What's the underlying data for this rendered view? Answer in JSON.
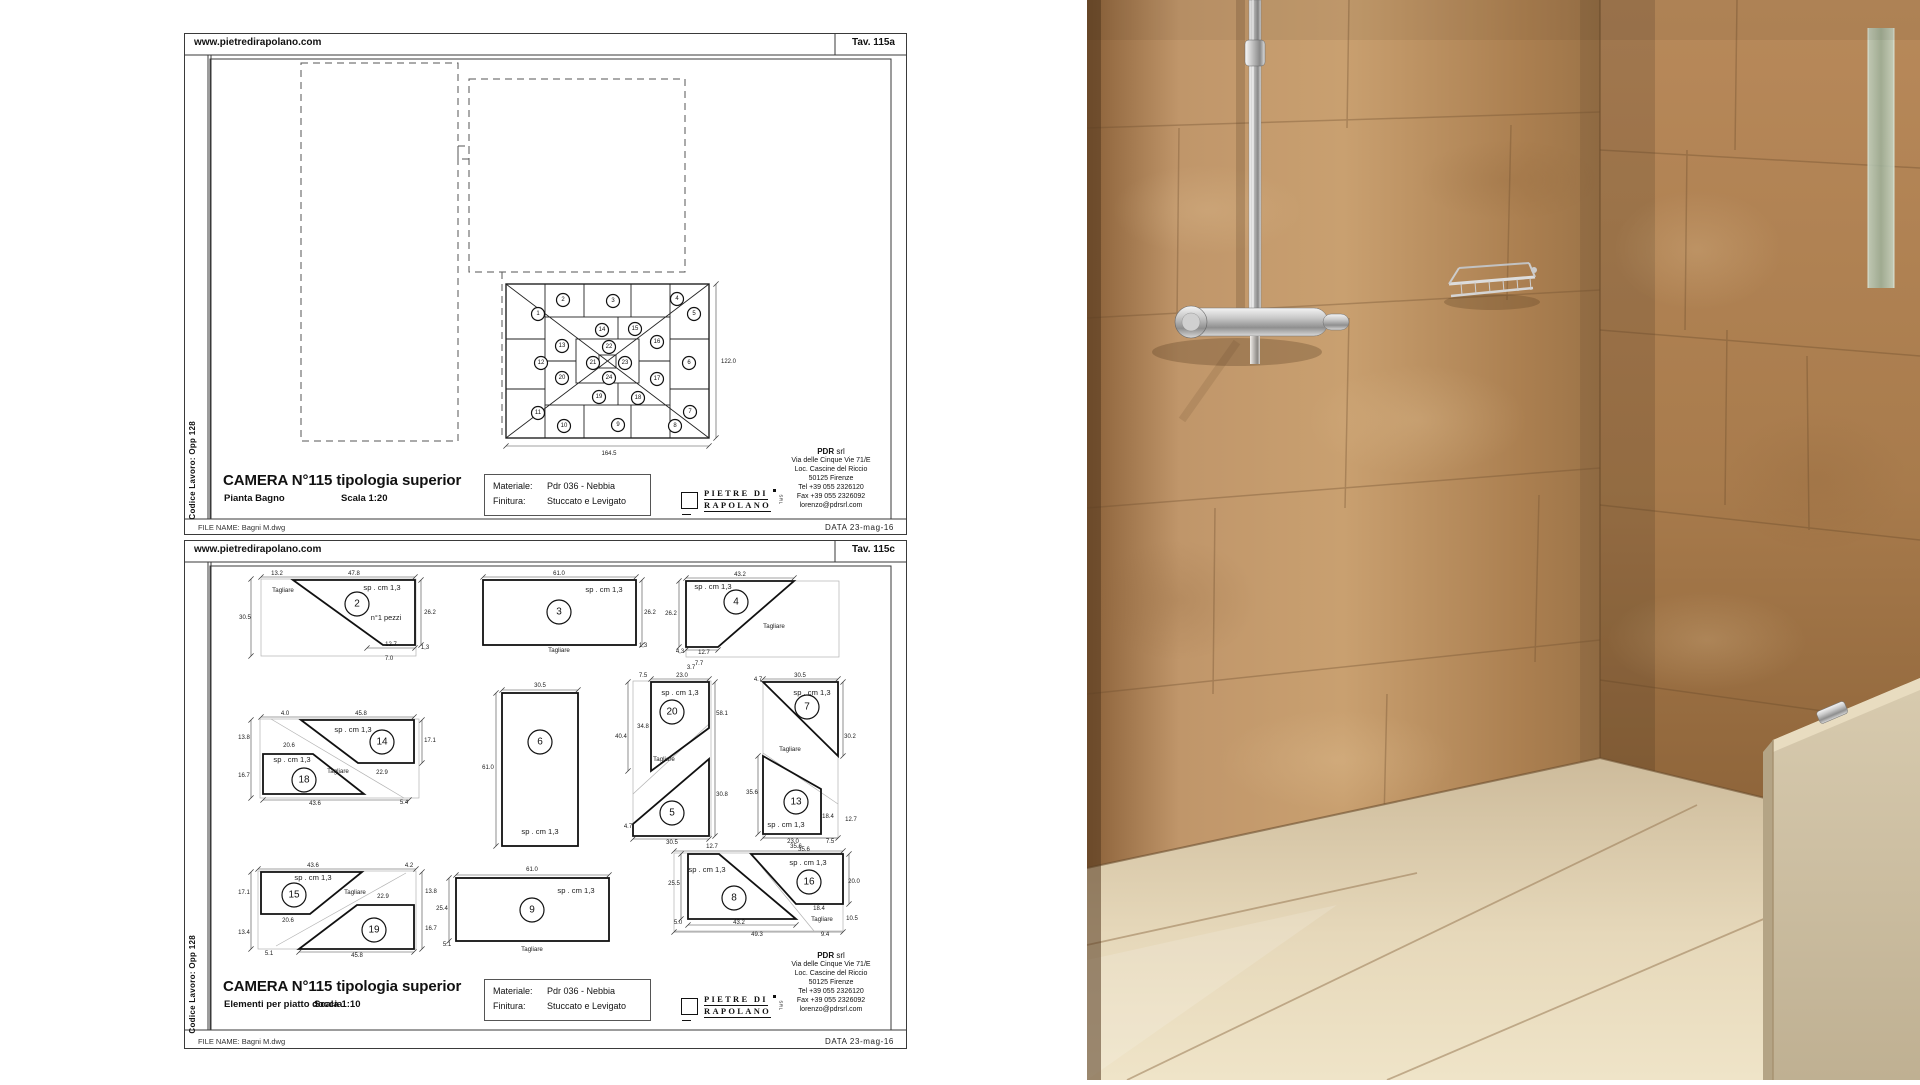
{
  "colors": {
    "paper": "#ffffff",
    "line": "#1a1a1a",
    "wall_left": "#c09366",
    "wall_right": "#a87a4b",
    "floor": "#e3d5b6",
    "half_wall": "#cfc1a5",
    "chrome": "#d9d9d9",
    "glass": "#a9bcae"
  },
  "sheet1": {
    "header": {
      "url": "www.pietredirapolano.com",
      "tav": "Tav. 115a"
    },
    "side_label": "Codice Lavoro: Opp 128",
    "title": "CAMERA N°115 tipologia superior",
    "subtitle": "Pianta Bagno",
    "scale": "Scala 1:20",
    "material_box": {
      "rows": [
        [
          "Materiale:",
          "Pdr 036 - Nebbia"
        ],
        [
          "Finitura:",
          "Stuccato e Levigato"
        ]
      ]
    },
    "logo": {
      "top": "PIETRE DI",
      "bottom": "RAPOLANO",
      "mark": "SRL"
    },
    "address": {
      "company": "PDR",
      "company_suffix": " srl",
      "lines": [
        "Via delle Cinque Vie 71/E",
        "Loc. Cascine del Riccio",
        "50125 Firenze",
        "Tel +39  055 2326120",
        "Fax +39 055 2326092",
        "lorenzo@pdrsrl.com"
      ]
    },
    "footer": {
      "file": "FILE NAME: Bagni M.dwg",
      "date": "DATA 23-mag-16"
    },
    "plan": {
      "dims": [
        [
          "122.0",
          536,
          329,
          "start"
        ],
        [
          "164.5",
          424,
          421,
          "middle"
        ]
      ],
      "dimlines": [
        [
          531,
          250,
          531,
          404
        ],
        [
          321,
          412,
          524,
          412
        ]
      ],
      "tile_numbers": [
        [
          1,
          353,
          280
        ],
        [
          2,
          378,
          266
        ],
        [
          3,
          428,
          267
        ],
        [
          4,
          492,
          265
        ],
        [
          5,
          509,
          280
        ],
        [
          6,
          504,
          329
        ],
        [
          7,
          505,
          378
        ],
        [
          8,
          490,
          392
        ],
        [
          9,
          433,
          391
        ],
        [
          10,
          379,
          392
        ],
        [
          11,
          353,
          379
        ],
        [
          12,
          356,
          329
        ],
        [
          13,
          377,
          312
        ],
        [
          14,
          417,
          296
        ],
        [
          15,
          450,
          295
        ],
        [
          16,
          472,
          308
        ],
        [
          17,
          472,
          345
        ],
        [
          18,
          453,
          364
        ],
        [
          19,
          414,
          363
        ],
        [
          20,
          377,
          344
        ],
        [
          21,
          408,
          329
        ],
        [
          22,
          424,
          313
        ],
        [
          23,
          440,
          329
        ],
        [
          24,
          424,
          344
        ]
      ]
    }
  },
  "sheet2": {
    "header": {
      "url": "www.pietredirapolano.com",
      "tav": "Tav. 115c"
    },
    "side_label": "Codice Lavoro: Opp 128",
    "title": "CAMERA N°115 tipologia superior",
    "subtitle": "Elementi per piatto doccia",
    "scale": "Scala 1:10",
    "material_box": {
      "rows": [
        [
          "Materiale:",
          "Pdr 036 - Nebbia"
        ],
        [
          "Finitura:",
          "Stuccato e Levigato"
        ]
      ]
    },
    "logo": {
      "top": "PIETRE DI",
      "bottom": "RAPOLANO",
      "mark": "SRL"
    },
    "address": {
      "company": "PDR",
      "company_suffix": " srl",
      "lines": [
        "Via delle Cinque Vie 71/E",
        "Loc. Cascine del Riccio",
        "50125 Firenze",
        "Tel +39  055 2326120",
        "Fax +39 055 2326092",
        "lorenzo@pdrsrl.com"
      ]
    },
    "footer": {
      "file": "FILE NAME: Bagni M.dwg",
      "date": "DATA 23-mag-16"
    },
    "drawing": {
      "piece_numbers": [
        [
          2,
          172,
          63
        ],
        [
          3,
          374,
          71
        ],
        [
          4,
          551,
          61
        ],
        [
          14,
          197,
          201
        ],
        [
          18,
          119,
          239
        ],
        [
          6,
          355,
          201
        ],
        [
          20,
          487,
          171
        ],
        [
          5,
          487,
          272
        ],
        [
          7,
          622,
          166
        ],
        [
          13,
          611,
          261
        ],
        [
          15,
          109,
          354
        ],
        [
          19,
          189,
          389
        ],
        [
          9,
          347,
          369
        ],
        [
          8,
          549,
          357
        ],
        [
          16,
          624,
          341
        ]
      ],
      "dimlines": [
        [
          76,
          36,
          230,
          36
        ],
        [
          66,
          38,
          66,
          115
        ],
        [
          236,
          39,
          236,
          104
        ],
        [
          182,
          107,
          230,
          107
        ],
        [
          298,
          36,
          451,
          36
        ],
        [
          457,
          39,
          457,
          104
        ],
        [
          501,
          37,
          609,
          37
        ],
        [
          494,
          40,
          494,
          106
        ],
        [
          501,
          109,
          533,
          109
        ],
        [
          76,
          176,
          229,
          176
        ],
        [
          66,
          179,
          66,
          257
        ],
        [
          237,
          179,
          237,
          222
        ],
        [
          78,
          259,
          224,
          259
        ],
        [
          317,
          149,
          393,
          149
        ],
        [
          311,
          152,
          311,
          305
        ],
        [
          466,
          138,
          524,
          138
        ],
        [
          443,
          141,
          443,
          230
        ],
        [
          530,
          141,
          530,
          295
        ],
        [
          448,
          298,
          524,
          298
        ],
        [
          578,
          138,
          653,
          138
        ],
        [
          573,
          215,
          573,
          293
        ],
        [
          658,
          141,
          658,
          215
        ],
        [
          578,
          297,
          653,
          297
        ],
        [
          73,
          328,
          231,
          328
        ],
        [
          66,
          331,
          66,
          408
        ],
        [
          237,
          331,
          237,
          408
        ],
        [
          114,
          411,
          229,
          411
        ],
        [
          271,
          334,
          424,
          334
        ],
        [
          264,
          337,
          264,
          400
        ],
        [
          489,
          310,
          658,
          310
        ],
        [
          496,
          313,
          496,
          378
        ],
        [
          664,
          313,
          664,
          363
        ],
        [
          503,
          384,
          611,
          384
        ],
        [
          489,
          391,
          658,
          391
        ]
      ],
      "annotations": [
        [
          "13.2",
          92,
          34
        ],
        [
          "47.8",
          169,
          34
        ],
        [
          "30.5",
          60,
          78
        ],
        [
          "Tagliare",
          98,
          51,
          "t"
        ],
        [
          "sp . cm 1,3",
          197,
          49,
          "l"
        ],
        [
          "n°1 pezzi",
          201,
          79,
          "p"
        ],
        [
          "26.2",
          245,
          73
        ],
        [
          "12.7",
          206,
          105
        ],
        [
          "7.0",
          204,
          119
        ],
        [
          "1,3",
          240,
          108
        ],
        [
          "61.0",
          374,
          34
        ],
        [
          "sp . cm 1,3",
          419,
          51,
          "l"
        ],
        [
          "26.2",
          465,
          73
        ],
        [
          "1,3",
          458,
          106
        ],
        [
          "Tagliare",
          374,
          111,
          "t"
        ],
        [
          "43.2",
          555,
          35
        ],
        [
          "sp . cm 1,3",
          528,
          48,
          "l"
        ],
        [
          "26.2",
          486,
          74
        ],
        [
          "Tagliare",
          589,
          87,
          "t"
        ],
        [
          "4,3",
          495,
          112
        ],
        [
          "12.7",
          519,
          113
        ],
        [
          "7.7",
          514,
          124
        ],
        [
          "4.0",
          100,
          174
        ],
        [
          "45.8",
          176,
          174
        ],
        [
          "13.8",
          59,
          198
        ],
        [
          "16.7",
          59,
          236
        ],
        [
          "sp . cm 1,3",
          168,
          191,
          "l"
        ],
        [
          "20.6",
          104,
          206
        ],
        [
          "17.1",
          245,
          201
        ],
        [
          "sp . cm 1,3",
          107,
          221,
          "l"
        ],
        [
          "Tagliare",
          153,
          232,
          "t"
        ],
        [
          "22.9",
          197,
          233
        ],
        [
          "43.6",
          130,
          264
        ],
        [
          "5.4",
          219,
          263
        ],
        [
          "30.5",
          355,
          146
        ],
        [
          "61.0",
          303,
          228
        ],
        [
          "sp . cm 1,3",
          355,
          293,
          "l"
        ],
        [
          "3.7",
          506,
          128
        ],
        [
          "7.5",
          458,
          136
        ],
        [
          "23.0",
          497,
          136
        ],
        [
          "4.7",
          573,
          140
        ],
        [
          "sp . cm 1,3",
          495,
          154,
          "l"
        ],
        [
          "58.1",
          537,
          174
        ],
        [
          "40.4",
          436,
          197
        ],
        [
          "34.8",
          458,
          187
        ],
        [
          "Tagliare",
          479,
          220,
          "t"
        ],
        [
          "30.8",
          537,
          255
        ],
        [
          "4.7",
          443,
          287
        ],
        [
          "30.5",
          487,
          303
        ],
        [
          "30.5",
          615,
          136
        ],
        [
          "sp . cm 1,3",
          627,
          154,
          "l"
        ],
        [
          "30.2",
          665,
          197
        ],
        [
          "35.6",
          567,
          253
        ],
        [
          "Tagliare",
          605,
          210,
          "t"
        ],
        [
          "18.4",
          643,
          277
        ],
        [
          "12.7",
          666,
          280
        ],
        [
          "sp . cm 1,3",
          601,
          286,
          "l"
        ],
        [
          "23.0",
          608,
          302
        ],
        [
          "7.5",
          645,
          302
        ],
        [
          "35.6",
          619,
          310
        ],
        [
          "43.6",
          128,
          326
        ],
        [
          "4.2",
          224,
          326
        ],
        [
          "17.1",
          59,
          353
        ],
        [
          "13.4",
          59,
          393
        ],
        [
          "sp . cm 1,3",
          128,
          339,
          "l"
        ],
        [
          "Tagliare",
          170,
          353,
          "t"
        ],
        [
          "22.9",
          198,
          357
        ],
        [
          "13.8",
          246,
          352
        ],
        [
          "16.7",
          246,
          389
        ],
        [
          "20.6",
          103,
          381
        ],
        [
          "45.8",
          172,
          416
        ],
        [
          "5.1",
          84,
          414
        ],
        [
          "61.0",
          347,
          330
        ],
        [
          "25.4",
          257,
          369
        ],
        [
          "sp . cm 1,3",
          391,
          352,
          "l"
        ],
        [
          "Tagliare",
          347,
          410,
          "t"
        ],
        [
          "5.1",
          262,
          405
        ],
        [
          "12.7",
          527,
          307
        ],
        [
          "35.6",
          611,
          307
        ],
        [
          "sp . cm 1,3",
          522,
          331,
          "l"
        ],
        [
          "sp . cm 1,3",
          623,
          324,
          "l"
        ],
        [
          "25.5",
          489,
          344
        ],
        [
          "20.0",
          669,
          342
        ],
        [
          "18.4",
          634,
          369
        ],
        [
          "10.5",
          667,
          379
        ],
        [
          "Tagliare",
          637,
          380,
          "t"
        ],
        [
          "5.0",
          493,
          383
        ],
        [
          "43.2",
          554,
          383
        ],
        [
          "49.3",
          572,
          395
        ],
        [
          "9.4",
          640,
          395
        ]
      ]
    }
  }
}
